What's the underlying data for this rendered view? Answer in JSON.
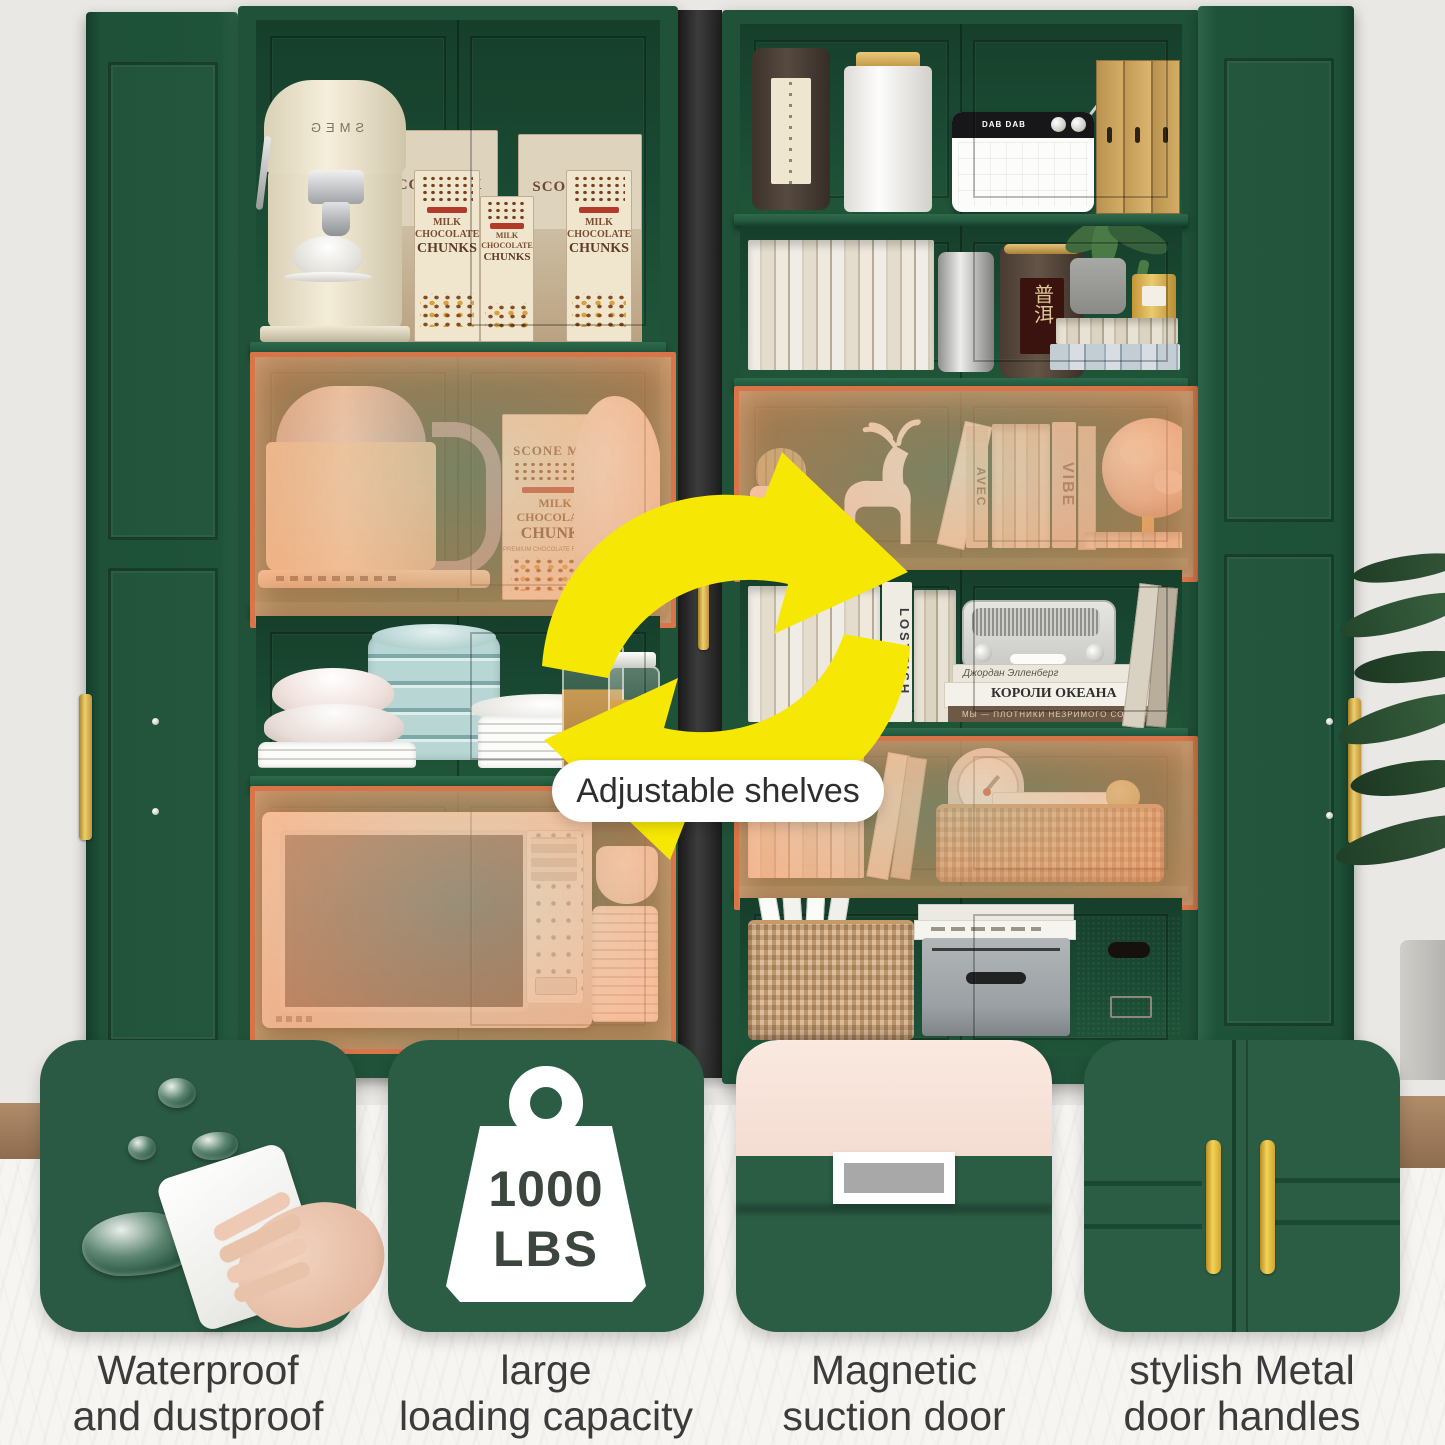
{
  "labels": {
    "adjustable": "Adjustable shelves"
  },
  "features": [
    {
      "line1": "Waterproof",
      "line2": "and dustproof"
    },
    {
      "line1": "large",
      "line2": "loading capacity",
      "weight_value": "1000",
      "weight_unit": "LBS"
    },
    {
      "line1": "Magnetic",
      "line2": "suction door"
    },
    {
      "line1": "stylish Metal",
      "line2": "door handles"
    }
  ],
  "left_cabinet": {
    "coffee_brand": "SMEG",
    "scone_box": "SCONE MIX",
    "choc": {
      "l1": "MILK",
      "l2": "CHOCOLATE",
      "l3": "CHUNKS",
      "sub": "PREMIUM CHOCOLATE FOR DESSERTS AND PASTRIES"
    }
  },
  "right_cabinet": {
    "radio_brand": "DAB DAB",
    "tea_label": "普洱",
    "books": {
      "avec": "AVEC",
      "vibe": "VIBE",
      "lostfish": "LOSTFISH",
      "ru_author": "Джордан Элленберг",
      "ru_title": "КОРОЛИ ОКЕАНА",
      "ru_sub": "МЫ — ПЛОТНИКИ НЕЗРИМОГО СОБОРА"
    }
  },
  "colors": {
    "cabinet_green": "#1f5138",
    "interior_green": "#17432e",
    "highlight_orange": "#dd7449",
    "accent_yellow": "#f7e704",
    "handle_gold": "#d9a93f",
    "tile_green": "#2b5d45"
  }
}
